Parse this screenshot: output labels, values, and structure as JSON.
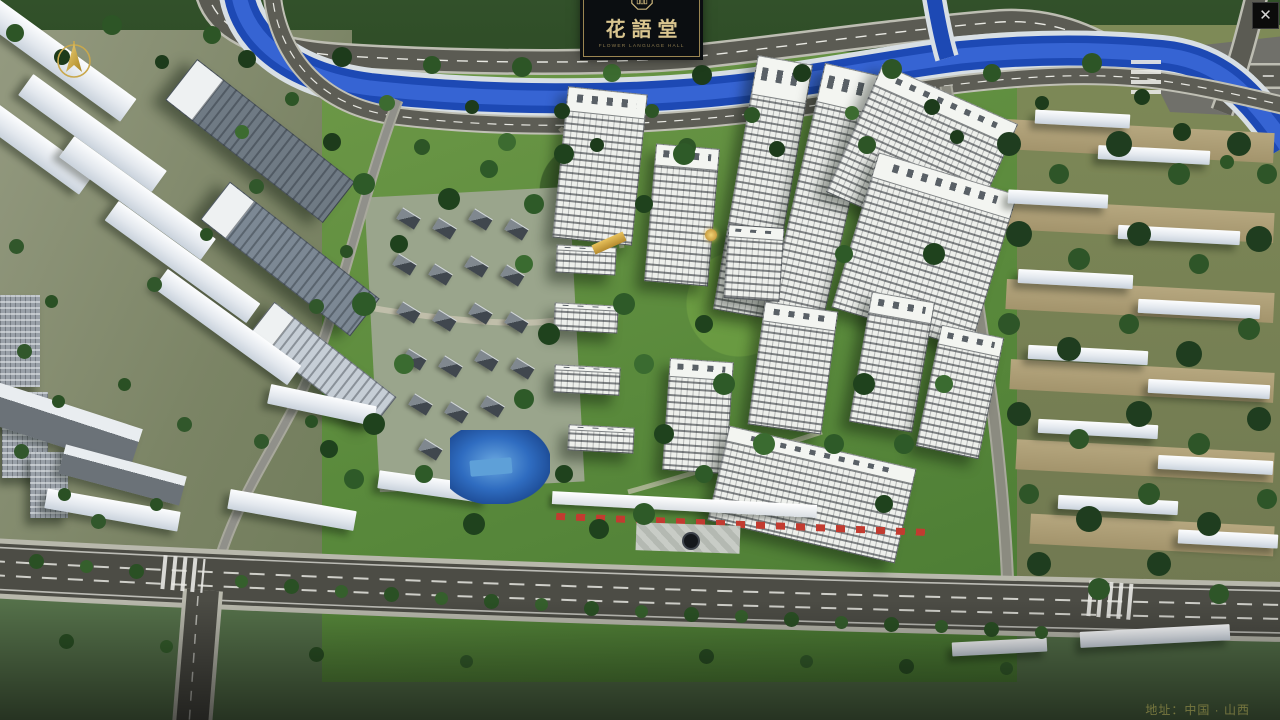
{
  "window": {
    "close_glyph": "✕"
  },
  "project": {
    "logo_title": "花語堂",
    "logo_subtitle": "FLOWER LANGUAGE HALL",
    "address": "地址：中国 · 山西"
  },
  "nav": {
    "items": [
      {
        "num": "o1",
        "label": "品牌 · 介绍",
        "sub": "BRAND SUPPORT"
      },
      {
        "num": "o2",
        "label": "区位 · 价值",
        "sub": "LOCATION VALUE"
      },
      {
        "num": "o3",
        "label": "项目 · 概况",
        "sub": "PROJECT SURVEY"
      },
      {
        "num": "o4",
        "label": "建筑 · 鉴赏",
        "sub": "APPRECIATION"
      },
      {
        "num": "o5",
        "label": "园林 · 景观",
        "sub": "GARDEN STREET"
      },
      {
        "num": "o6",
        "label": "精装 · 体验",
        "sub": "EXPERIENCE"
      },
      {
        "num": "o7",
        "label": "户型 · 分布",
        "sub": "SHOW ROOM"
      },
      {
        "num": "o8",
        "label": "一房 · 一景",
        "sub": "COMMUNITY"
      }
    ]
  },
  "colors": {
    "accent_gold": "#cfbb80",
    "panel_dark": "#0b0e11",
    "river_blue": "#1d49b4",
    "navbar_bg": "rgba(9,11,13,0.78)"
  }
}
